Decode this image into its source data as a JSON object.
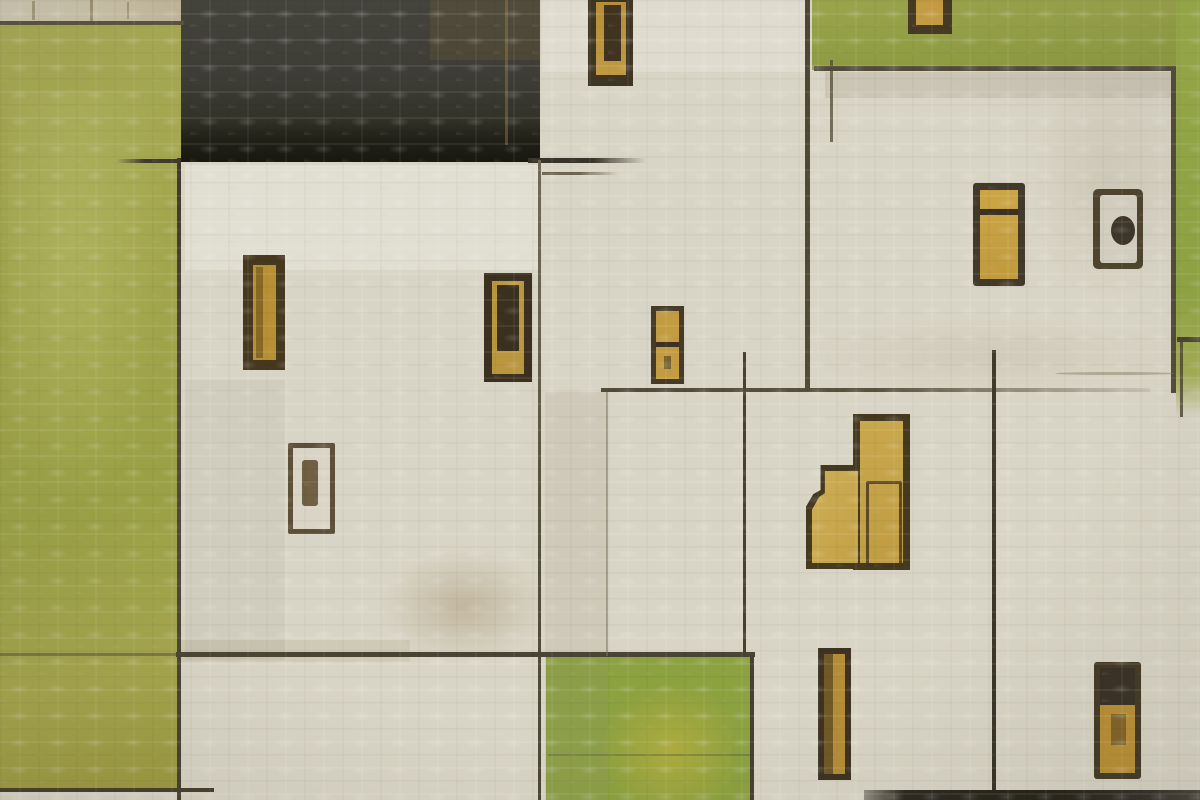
{
  "artwork": {
    "type": "abstract-painting",
    "subject": "textured canvas painting of flat white village houses with gold windows and doors, an olive-green field left, green patches top-right and bottom-center, a dark charcoal roof block, and sketched dark outlines",
    "palette": {
      "canvas_cream": "#d9d5c6",
      "olive_green_left": "#a2a54c",
      "green_top_right": "#93a047",
      "green_bottom": "#8ca140",
      "green_strip_right": "#98ab49",
      "roof_charcoal": "#3b3a32",
      "window_gold": "#c09a42",
      "frame_dark": "#423721",
      "sketch_line": "#4a4434"
    },
    "canvas": {
      "width": 1200,
      "height": 800,
      "base": "#d9d5c6"
    },
    "shapes": [
      {
        "n": "wall-strip-top-left",
        "x": 0,
        "y": 0,
        "w": 184,
        "h": 23,
        "bg": "linear-gradient(90deg,#cfc9b3,#cbc2a8 60%,#c1b69a)"
      },
      {
        "n": "wall-mark-1",
        "x": 32,
        "y": 1,
        "w": 3,
        "h": 19,
        "bg": "rgba(115,100,65,.45)"
      },
      {
        "n": "wall-mark-2",
        "x": 90,
        "y": 0,
        "w": 3,
        "h": 21,
        "bg": "rgba(115,100,65,.5)"
      },
      {
        "n": "wall-mark-3",
        "x": 127,
        "y": 2,
        "w": 2,
        "h": 17,
        "bg": "rgba(115,100,65,.4)"
      },
      {
        "n": "green-field-left",
        "x": 0,
        "y": 21,
        "w": 181,
        "h": 769,
        "bg": "linear-gradient(168deg,#a9ab55 0%,#a2a54c 35%,#9aa046 62%,#a6a64e 84%,#9c9a40 100%)"
      },
      {
        "n": "green-field-left-highlight",
        "x": 8,
        "y": 90,
        "w": 162,
        "h": 430,
        "bg": "radial-gradient(ellipse at 40% 35%, rgba(229,233,162,.18), rgba(229,233,162,0) 70%)"
      },
      {
        "n": "roof-block",
        "x": 181,
        "y": 0,
        "w": 359,
        "h": 162,
        "bg": "linear-gradient(180deg,#45443c 0%,#3d3c35 50%,#343329 72%,#262519 100%)"
      },
      {
        "n": "roof-dark-band",
        "x": 181,
        "y": 120,
        "w": 359,
        "h": 42,
        "bg": "linear-gradient(180deg, rgba(22,21,15,0), rgba(22,21,15,.5) 50%, rgba(17,17,11,.62))"
      },
      {
        "n": "roof-brown-tinge",
        "x": 430,
        "y": 0,
        "w": 110,
        "h": 60,
        "bg": "rgba(125,104,58,.22)"
      },
      {
        "n": "roof-gold-fleck",
        "x": 505,
        "y": 0,
        "w": 3,
        "h": 145,
        "bg": "rgba(165,135,68,.4)"
      },
      {
        "n": "green-field-top-right",
        "x": 812,
        "y": 0,
        "w": 366,
        "h": 70,
        "bg": "linear-gradient(180deg,#9aa54c,#8e9b41)"
      },
      {
        "n": "green-strip-right",
        "x": 1176,
        "y": 0,
        "w": 24,
        "h": 416,
        "bg": "linear-gradient(180deg,#9aad4a 0%,#90a443 70%,#a3ad56 90%, rgba(163,173,86,0) 100%)"
      },
      {
        "n": "green-field-bottom-mid",
        "x": 546,
        "y": 656,
        "w": 208,
        "h": 144,
        "bg": "#8ca140"
      },
      {
        "n": "green-bottom-yellow-blotch",
        "x": 598,
        "y": 678,
        "w": 134,
        "h": 122,
        "bg": "radial-gradient(ellipse at 55% 60%, rgba(201,181,62,.55), rgba(201,181,62,0) 70%)"
      },
      {
        "n": "green-bottom-pencil-line",
        "x": 548,
        "y": 754,
        "w": 204,
        "h": 2,
        "bg": "rgba(80,75,58,.3)"
      },
      {
        "n": "stain-white-under-roof",
        "x": 185,
        "y": 165,
        "w": 355,
        "h": 105,
        "bg": "rgba(255,255,255,.22)"
      },
      {
        "n": "stain-smudge-left-house",
        "x": 380,
        "y": 550,
        "w": 168,
        "h": 112,
        "bg": "radial-gradient(ellipse, rgba(142,112,66,.30), rgba(142,112,66,0) 70%)"
      },
      {
        "n": "stain-smudge-left-house-2",
        "x": 180,
        "y": 640,
        "w": 230,
        "h": 22,
        "bg": "rgba(142,112,66,.12)"
      },
      {
        "n": "stain-column-shade-mid",
        "x": 545,
        "y": 392,
        "w": 62,
        "h": 408,
        "bg": "rgba(152,142,118,.16)"
      },
      {
        "n": "stain-band-under-right-roofline",
        "x": 825,
        "y": 72,
        "w": 348,
        "h": 26,
        "bg": "rgba(130,120,92,.16)"
      },
      {
        "n": "stain-streak-right-house",
        "x": 1035,
        "y": 85,
        "w": 140,
        "h": 210,
        "bg": "radial-gradient(ellipse, rgba(150,140,112,.15), rgba(150,140,112,0) 75%)"
      },
      {
        "n": "stain-bright-top-mid",
        "x": 542,
        "y": 0,
        "w": 265,
        "h": 72,
        "bg": "rgba(255,255,255,.16)"
      },
      {
        "n": "stain-right-house-bottom",
        "x": 815,
        "y": 320,
        "w": 355,
        "h": 70,
        "bg": "radial-gradient(ellipse, rgba(160,150,122,.16), rgba(160,150,122,0) 75%)"
      },
      {
        "n": "stain-left-house-grey",
        "x": 185,
        "y": 380,
        "w": 100,
        "h": 280,
        "bg": "rgba(120,115,100,.08)"
      },
      {
        "n": "line-wall-strip-bottom",
        "x": 0,
        "y": 21,
        "w": 184,
        "h": 4,
        "bg": "#5b533d"
      },
      {
        "n": "line-left-house-edge",
        "x": 177,
        "y": 158,
        "w": 4,
        "h": 642,
        "bg": "linear-gradient(180deg,#3e392c,#514c3b 40%,#45402f)"
      },
      {
        "n": "line-roof-tick-left",
        "x": 116,
        "y": 159,
        "w": 64,
        "h": 4,
        "bg": "linear-gradient(90deg, rgba(63,58,45,0), #3f3a2d 45%)"
      },
      {
        "n": "line-roof-tick-right",
        "x": 528,
        "y": 158,
        "w": 118,
        "h": 5,
        "bg": "linear-gradient(90deg,#38332a 55%, rgba(56,51,42,0))"
      },
      {
        "n": "line-roof-tick-right-2",
        "x": 542,
        "y": 172,
        "w": 76,
        "h": 3,
        "bg": "linear-gradient(90deg,#6e6553 50%, rgba(110,101,83,0))"
      },
      {
        "n": "line-mid-vertical",
        "x": 538,
        "y": 160,
        "w": 3,
        "h": 640,
        "bg": "linear-gradient(180deg,#6f6856 0%,#655e4c 30%,#54503e 55%,#4a4635 100%)"
      },
      {
        "n": "line-horizontal-655-left",
        "x": 0,
        "y": 653,
        "w": 178,
        "h": 3,
        "bg": "rgba(88,84,66,.55)"
      },
      {
        "n": "line-horizontal-655",
        "x": 176,
        "y": 652,
        "w": 579,
        "h": 5,
        "bg": "#4a4434"
      },
      {
        "n": "line-faint-vertical-608",
        "x": 606,
        "y": 391,
        "w": 2,
        "h": 265,
        "bg": "rgba(122,114,94,.55)"
      },
      {
        "n": "line-horizontal-390",
        "x": 601,
        "y": 388,
        "w": 549,
        "h": 4,
        "bg": "linear-gradient(90deg,#514b3a,#59533f 50%, rgba(95,88,68,.12))"
      },
      {
        "n": "line-vertical-806",
        "x": 805,
        "y": 0,
        "w": 5,
        "h": 391,
        "bg": "linear-gradient(180deg,#4c4735,#514b39)"
      },
      {
        "n": "line-right-house-top",
        "x": 814,
        "y": 66,
        "w": 362,
        "h": 5,
        "bg": "#514b38"
      },
      {
        "n": "line-right-house-edge",
        "x": 1171,
        "y": 66,
        "w": 5,
        "h": 327,
        "bg": "#524c39"
      },
      {
        "n": "line-vertical-995",
        "x": 992,
        "y": 350,
        "w": 4,
        "h": 445,
        "bg": "linear-gradient(180deg,#413b2c,#383328)"
      },
      {
        "n": "line-vertical-745",
        "x": 743,
        "y": 352,
        "w": 3,
        "h": 305,
        "bg": "#46412f"
      },
      {
        "n": "line-green-block-right-edge",
        "x": 750,
        "y": 655,
        "w": 4,
        "h": 145,
        "bg": "#45402f"
      },
      {
        "n": "line-right-edge-tick",
        "x": 1177,
        "y": 337,
        "w": 23,
        "h": 5,
        "bg": "#4a4434"
      },
      {
        "n": "line-vertical-1181",
        "x": 1180,
        "y": 341,
        "w": 3,
        "h": 76,
        "bg": "rgba(72,66,49,.8)"
      },
      {
        "n": "line-bottom-left",
        "x": 0,
        "y": 788,
        "w": 214,
        "h": 4,
        "bg": "#46412f"
      },
      {
        "n": "bottom-dark-strip",
        "x": 864,
        "y": 790,
        "w": 336,
        "h": 10,
        "bg": "linear-gradient(90deg, rgba(42,39,29,.4), #2c2920 12%, #252318 55%, #35312a 85%, #4a463c)"
      },
      {
        "n": "line-stroke-833",
        "x": 830,
        "y": 60,
        "w": 3,
        "h": 82,
        "bg": "rgba(82,74,54,.75)"
      },
      {
        "n": "line-right-house-bottom-curve",
        "x": 1055,
        "y": 372,
        "w": 120,
        "h": 3,
        "bg": "rgba(135,125,100,.5)",
        "r": "50%"
      },
      {
        "n": "window-1-frame",
        "x": 588,
        "y": 0,
        "w": 45,
        "h": 86,
        "bg": "#3f3524"
      },
      {
        "n": "window-1-glass",
        "x": 596,
        "y": 2,
        "w": 30,
        "h": 73,
        "bg": "linear-gradient(180deg,#b68e38,#c09a42)"
      },
      {
        "n": "window-1-inner-dark",
        "x": 604,
        "y": 5,
        "w": 17,
        "h": 56,
        "bg": "#403420"
      },
      {
        "n": "window-2-frame",
        "x": 908,
        "y": 0,
        "w": 44,
        "h": 34,
        "bg": "#473a24"
      },
      {
        "n": "window-2-glass",
        "x": 916,
        "y": 0,
        "w": 27,
        "h": 25,
        "bg": "#c59d43"
      },
      {
        "n": "window-3-frame",
        "x": 973,
        "y": 183,
        "w": 52,
        "h": 103,
        "bg": "#42392a",
        "r": "3px"
      },
      {
        "n": "window-3-glass",
        "x": 980,
        "y": 190,
        "w": 38,
        "h": 89,
        "bg": "linear-gradient(180deg,#cba545,#c19a3e)"
      },
      {
        "n": "window-3-divider",
        "x": 980,
        "y": 209,
        "w": 38,
        "h": 6,
        "bg": "#3a3122"
      },
      {
        "n": "window-4-frame",
        "x": 1093,
        "y": 189,
        "w": 50,
        "h": 80,
        "bg": "#4f442e",
        "r": "5px"
      },
      {
        "n": "window-4-glass",
        "x": 1100,
        "y": 195,
        "w": 37,
        "h": 68,
        "bg": "#d3cfc0",
        "r": "3px"
      },
      {
        "n": "window-4-dot",
        "x": 1111,
        "y": 216,
        "w": 24,
        "h": 29,
        "bg": "#3e362a",
        "r": "50%"
      },
      {
        "n": "window-5-frame",
        "x": 243,
        "y": 255,
        "w": 42,
        "h": 115,
        "bg": "#46381e"
      },
      {
        "n": "window-5-glass",
        "x": 253,
        "y": 265,
        "w": 23,
        "h": 95,
        "bg": "#b78f34"
      },
      {
        "n": "window-5-streak",
        "x": 256,
        "y": 267,
        "w": 7,
        "h": 91,
        "bg": "rgba(94,72,30,.55)"
      },
      {
        "n": "window-6-frame",
        "x": 288,
        "y": 443,
        "w": 47,
        "h": 91,
        "bg": "#5e5037",
        "r": "2px"
      },
      {
        "n": "window-6-glass",
        "x": 293,
        "y": 448,
        "w": 37,
        "h": 81,
        "bg": "#d9d4c5"
      },
      {
        "n": "window-6-mark",
        "x": 302,
        "y": 460,
        "w": 16,
        "h": 46,
        "bg": "#6f5f43",
        "r": "3px"
      },
      {
        "n": "window-7-frame",
        "x": 484,
        "y": 273,
        "w": 48,
        "h": 109,
        "bg": "#3c3120"
      },
      {
        "n": "window-7-glass",
        "x": 492,
        "y": 281,
        "w": 32,
        "h": 93,
        "bg": "#ba963f"
      },
      {
        "n": "window-7-inner-dark",
        "x": 497,
        "y": 285,
        "w": 22,
        "h": 66,
        "bg": "#393020"
      },
      {
        "n": "window-8-frame",
        "x": 651,
        "y": 306,
        "w": 33,
        "h": 78,
        "bg": "#463b26"
      },
      {
        "n": "window-8-glass",
        "x": 656,
        "y": 311,
        "w": 23,
        "h": 68,
        "bg": "#c39c42"
      },
      {
        "n": "window-8-divider",
        "x": 656,
        "y": 342,
        "w": 23,
        "h": 5,
        "bg": "#3b3223"
      },
      {
        "n": "window-8-mark",
        "x": 664,
        "y": 356,
        "w": 7,
        "h": 13,
        "bg": "rgba(70,58,34,.6)"
      },
      {
        "n": "door-right-column-frame",
        "x": 853,
        "y": 414,
        "w": 57,
        "h": 156,
        "bg": "#453920"
      },
      {
        "n": "door-right-column-glass",
        "x": 860,
        "y": 421,
        "w": 43,
        "h": 142,
        "bg": "linear-gradient(180deg,#c8a74d,#c09d43)"
      },
      {
        "n": "door-left-part-frame",
        "x": 806,
        "y": 465,
        "w": 52,
        "h": 104,
        "bg": "#453920",
        "cp": "polygon(28% 0, 100% 0, 100% 100%, 0 100%, 0 40%, 14% 28%, 28% 24%)"
      },
      {
        "n": "door-left-part-glass",
        "x": 812,
        "y": 471,
        "w": 46,
        "h": 92,
        "bg": "linear-gradient(120deg,#cdae56,#c3a146)",
        "cp": "polygon(28% 0, 100% 0, 100% 100%, 0 100%, 0 42%, 16% 28%, 28% 24%)"
      },
      {
        "n": "door-panel-outline",
        "x": 866,
        "y": 481,
        "w": 30,
        "h": 80,
        "bd": "3px solid rgba(66,53,30,.8)",
        "r": "2px"
      },
      {
        "n": "window-10-frame",
        "x": 818,
        "y": 648,
        "w": 33,
        "h": 132,
        "bg": "#3e3322"
      },
      {
        "n": "window-10-glass",
        "x": 824,
        "y": 654,
        "w": 21,
        "h": 120,
        "bg": "#b58d37"
      },
      {
        "n": "window-10-left-band",
        "x": 824,
        "y": 654,
        "w": 9,
        "h": 120,
        "bg": "rgba(56,46,28,.55)"
      },
      {
        "n": "window-11-frame",
        "x": 1094,
        "y": 662,
        "w": 47,
        "h": 117,
        "bg": "#443a28",
        "r": "3px"
      },
      {
        "n": "window-11-glass-top",
        "x": 1100,
        "y": 668,
        "w": 35,
        "h": 37,
        "bg": "#3a3226"
      },
      {
        "n": "window-11-glass-bottom",
        "x": 1100,
        "y": 705,
        "w": 35,
        "h": 68,
        "bg": "#ba9036"
      },
      {
        "n": "window-11-speckle",
        "x": 1111,
        "y": 714,
        "w": 15,
        "h": 31,
        "bg": "rgba(58,47,27,.45)"
      }
    ]
  }
}
